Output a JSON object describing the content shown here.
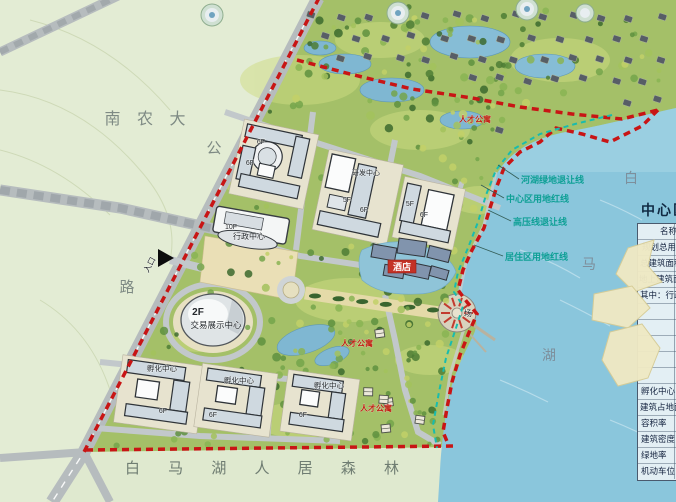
{
  "colors": {
    "boundary_red": "#c81515",
    "setback_teal": "#18bcae",
    "label_teal": "#0fa096",
    "lake_blue": "#8ac6dc",
    "land_pale": "#e3ecd4",
    "road_gray": "#b9bfc2",
    "accent_red": "#c23b2f"
  },
  "map": {
    "labels": [
      {
        "name": "label-nannongda",
        "type": "area",
        "text": "南 农 大",
        "x": 148,
        "y": 124,
        "size": 16
      },
      {
        "name": "label-highway-gong",
        "type": "area",
        "text": "公",
        "x": 217,
        "y": 153,
        "size": 15
      },
      {
        "name": "label-highway-lu",
        "type": "area",
        "text": "路",
        "x": 130,
        "y": 292,
        "size": 15
      },
      {
        "name": "label-lake-bai",
        "type": "lake",
        "text": "白",
        "x": 631,
        "y": 183,
        "size": 14
      },
      {
        "name": "label-lake-ma",
        "type": "lake",
        "text": "马",
        "x": 589,
        "y": 269,
        "size": 14
      },
      {
        "name": "label-lake-hu",
        "type": "lake",
        "text": "湖",
        "x": 549,
        "y": 360,
        "size": 14
      },
      {
        "name": "label-baimahu-forest",
        "type": "area2",
        "text": "白 马 湖 人 居 森 林",
        "x": 268,
        "y": 473,
        "size": 15
      },
      {
        "name": "label-river-green-setback",
        "type": "setback",
        "text": "河湖绿地退让线",
        "x": 521,
        "y": 183,
        "size": 9,
        "leader": [
          519,
          179,
          498,
          165
        ]
      },
      {
        "name": "label-center-red-line",
        "type": "setback",
        "text": "中心区用地红线",
        "x": 506,
        "y": 202,
        "size": 9,
        "leader": [
          504,
          198,
          481,
          185
        ]
      },
      {
        "name": "label-hv-setback",
        "type": "setback",
        "text": "高压线退让线",
        "x": 513,
        "y": 225,
        "size": 9,
        "leader": [
          511,
          221,
          488,
          210
        ]
      },
      {
        "name": "label-residential-red-line",
        "type": "setback",
        "text": "居住区用地红线",
        "x": 505,
        "y": 260,
        "size": 9,
        "leader": [
          503,
          256,
          474,
          245
        ]
      },
      {
        "name": "label-floors",
        "type": "bldg",
        "text": "6F",
        "x": 261,
        "y": 144,
        "size": 7
      },
      {
        "name": "label-floors",
        "type": "bldg",
        "text": "6F",
        "x": 250,
        "y": 165,
        "size": 7
      },
      {
        "name": "label-rd-center",
        "type": "bldg",
        "text": "研发中心",
        "x": 366,
        "y": 175,
        "size": 7
      },
      {
        "name": "label-floors",
        "type": "bldg",
        "text": "5F",
        "x": 347,
        "y": 202,
        "size": 7
      },
      {
        "name": "label-floors",
        "type": "bldg",
        "text": "6F",
        "x": 364,
        "y": 212,
        "size": 7
      },
      {
        "name": "label-floors",
        "type": "bldg",
        "text": "5F",
        "x": 410,
        "y": 206,
        "size": 7
      },
      {
        "name": "label-floors",
        "type": "bldg",
        "text": "6F",
        "x": 424,
        "y": 217,
        "size": 7
      },
      {
        "name": "label-floors",
        "type": "bldg",
        "text": "10F",
        "x": 231,
        "y": 229,
        "size": 7
      },
      {
        "name": "label-admin-center",
        "type": "bldg",
        "text": "行政中心",
        "x": 249,
        "y": 239,
        "size": 8
      },
      {
        "name": "label-entrance",
        "type": "bldg",
        "text": "入口",
        "x": 152,
        "y": 266,
        "size": 8,
        "rot": -62
      },
      {
        "name": "label-floors",
        "type": "bldg",
        "text": "2F",
        "x": 198,
        "y": 315,
        "size": 10,
        "bold": true
      },
      {
        "name": "label-trade-exhibition-center",
        "type": "bldg",
        "text": "交易展示中心",
        "x": 216,
        "y": 328,
        "size": 8.5
      },
      {
        "name": "label-plaza",
        "type": "bldg",
        "text": "场",
        "x": 468,
        "y": 316,
        "size": 8
      },
      {
        "name": "label-incubator-center",
        "type": "bldg",
        "text": "孵化中心",
        "x": 162,
        "y": 371,
        "size": 7.5
      },
      {
        "name": "label-incubator-center",
        "type": "bldg",
        "text": "孵化中心",
        "x": 239,
        "y": 383,
        "size": 7.5
      },
      {
        "name": "label-incubator-center",
        "type": "bldg",
        "text": "孵化中心",
        "x": 329,
        "y": 388,
        "size": 7.5
      },
      {
        "name": "label-floors",
        "type": "bldg",
        "text": "6F",
        "x": 163,
        "y": 413,
        "size": 7
      },
      {
        "name": "label-floors",
        "type": "bldg",
        "text": "6F",
        "x": 213,
        "y": 417,
        "size": 7
      },
      {
        "name": "label-floors",
        "type": "bldg",
        "text": "6F",
        "x": 303,
        "y": 417,
        "size": 7
      },
      {
        "name": "label-apartments",
        "type": "red",
        "text": "人才公寓",
        "x": 475,
        "y": 122,
        "size": 8
      },
      {
        "name": "label-apartments",
        "type": "red",
        "text": "人才公寓",
        "x": 357,
        "y": 346,
        "size": 8
      },
      {
        "name": "label-apartments",
        "type": "red",
        "text": "人才公寓",
        "x": 376,
        "y": 411,
        "size": 8
      },
      {
        "name": "label-hotel",
        "type": "badge",
        "text": "酒店",
        "x": 402,
        "y": 270,
        "size": 9
      }
    ]
  },
  "panel": {
    "title": "中心区",
    "rows": [
      {
        "text": "名称",
        "indent": 22
      },
      {
        "text": "规划总用地",
        "indent": 4
      },
      {
        "text": "总建筑面积",
        "indent": 2
      },
      {
        "text": "地上建筑面积",
        "indent": 1
      },
      {
        "text": "其中：行政",
        "indent": 2
      },
      {
        "text": "",
        "indent": 0
      },
      {
        "text": "",
        "indent": 0
      },
      {
        "text": "",
        "indent": 0
      },
      {
        "text": "",
        "indent": 0
      },
      {
        "text": "",
        "indent": 0
      },
      {
        "text": "孵化中心",
        "indent": 3
      },
      {
        "text": "建筑占地面积",
        "indent": 2
      },
      {
        "text": "容积率",
        "indent": 3
      },
      {
        "text": "建筑密度",
        "indent": 3
      },
      {
        "text": "绿地率",
        "indent": 3
      },
      {
        "text": "机动车位",
        "indent": 3
      }
    ]
  }
}
